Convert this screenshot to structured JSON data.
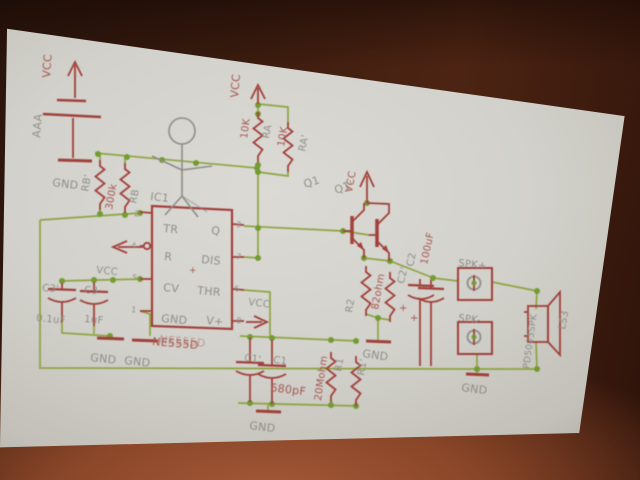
{
  "scene": {
    "type": "projected-circuit-schematic-photo",
    "colors": {
      "wire_green": "#8ba23a",
      "junction_green": "#6f9a2c",
      "symbol_red": "#a03a35",
      "text_gray": "#8d8a84",
      "text_red": "#a5514b",
      "screen_white": "#d6d5d0",
      "room_brown": "#3c1c0f"
    }
  },
  "schematic": {
    "ic": {
      "name": "IC1",
      "value": "NE555D",
      "pins_left": [
        "TR",
        "R",
        "CV",
        "GND"
      ],
      "pins_right": [
        "Q",
        "DIS",
        "THR",
        "V+"
      ],
      "pin_numbers_left": [
        "2",
        "4",
        "5",
        "1"
      ],
      "pin_numbers_right": [
        "3",
        "7",
        "6",
        "8"
      ]
    },
    "components": [
      {
        "name": "BAT",
        "value": "AAA"
      },
      {
        "name": "RB/RB'",
        "value": "300k"
      },
      {
        "name": "RA/RA'",
        "value": "10K"
      },
      {
        "name": "R1/R1'",
        "value": "20Mohm"
      },
      {
        "name": "R2/R2'",
        "value": "82ohm"
      },
      {
        "name": "C1/C1'",
        "value": "680pF"
      },
      {
        "name": "C2/C2'",
        "value": "100uF"
      },
      {
        "name": "C3/C3'",
        "value": "0.1uF / 1uF"
      },
      {
        "name": "Q1/Q1'",
        "value": ""
      },
      {
        "name": "LS3",
        "value": "PD5003SPK"
      },
      {
        "name": "SPK+",
        "value": ""
      },
      {
        "name": "SPK-",
        "value": ""
      }
    ],
    "labels": [
      {
        "id": "vcc-battery-label",
        "text": "VCC",
        "x": 50,
        "y": 78,
        "rot": -86,
        "c": "r",
        "s": 11
      },
      {
        "id": "battery-name",
        "text": "AAA",
        "x": 40,
        "y": 138,
        "rot": -85,
        "c": "g",
        "s": 11
      },
      {
        "id": "gnd-battery-label",
        "text": "GND",
        "x": 52,
        "y": 186,
        "rot": 7,
        "c": "g",
        "s": 11
      },
      {
        "id": "rb2-name",
        "text": "RB'",
        "x": 88,
        "y": 192,
        "rot": -80,
        "c": "g",
        "s": 10
      },
      {
        "id": "rb-value",
        "text": "300k",
        "x": 112,
        "y": 210,
        "rot": -80,
        "c": "r",
        "s": 10
      },
      {
        "id": "rb-name",
        "text": "RB",
        "x": 136,
        "y": 204,
        "rot": -78,
        "c": "g",
        "s": 10
      },
      {
        "id": "ic1-name",
        "text": "IC1",
        "x": 150,
        "y": 200,
        "rot": 6,
        "c": "g",
        "s": 11
      },
      {
        "id": "pin-tr",
        "text": "TR",
        "x": 163,
        "y": 232,
        "rot": 5,
        "c": "g",
        "s": 11
      },
      {
        "id": "pin-q",
        "text": "Q",
        "x": 211,
        "y": 234,
        "rot": 5,
        "c": "g",
        "s": 11
      },
      {
        "id": "pin-r",
        "text": "R",
        "x": 164,
        "y": 260,
        "rot": 5,
        "c": "g",
        "s": 11
      },
      {
        "id": "pin-dis",
        "text": "DIS",
        "x": 201,
        "y": 263,
        "rot": 5,
        "c": "g",
        "s": 11
      },
      {
        "id": "pin-cv",
        "text": "CV",
        "x": 163,
        "y": 291,
        "rot": 5,
        "c": "g",
        "s": 11
      },
      {
        "id": "pin-thr",
        "text": "THR",
        "x": 197,
        "y": 294,
        "rot": 5,
        "c": "g",
        "s": 11
      },
      {
        "id": "pin-gnd",
        "text": "GND",
        "x": 161,
        "y": 322,
        "rot": 5,
        "c": "g",
        "s": 11
      },
      {
        "id": "pin-vplus",
        "text": "V+",
        "x": 206,
        "y": 324,
        "rot": 5,
        "c": "g",
        "s": 11
      },
      {
        "id": "pin-num-2",
        "text": "2",
        "x": 134,
        "y": 216,
        "rot": 5,
        "c": "g",
        "s": 8
      },
      {
        "id": "pin-num-4",
        "text": "4",
        "x": 131,
        "y": 248,
        "rot": 5,
        "c": "g",
        "s": 8
      },
      {
        "id": "pin-num-5",
        "text": "5",
        "x": 132,
        "y": 280,
        "rot": 5,
        "c": "g",
        "s": 8
      },
      {
        "id": "pin-num-1",
        "text": "1",
        "x": 131,
        "y": 312,
        "rot": 5,
        "c": "g",
        "s": 8
      },
      {
        "id": "pin-num-3",
        "text": "3",
        "x": 236,
        "y": 227,
        "rot": 5,
        "c": "g",
        "s": 8
      },
      {
        "id": "pin-num-7",
        "text": "7",
        "x": 236,
        "y": 259,
        "rot": 5,
        "c": "g",
        "s": 8
      },
      {
        "id": "pin-num-6",
        "text": "6",
        "x": 234,
        "y": 291,
        "rot": 5,
        "c": "g",
        "s": 8
      },
      {
        "id": "pin-num-8",
        "text": "8",
        "x": 236,
        "y": 323,
        "rot": 5,
        "c": "g",
        "s": 8
      },
      {
        "id": "ic-origin-cross",
        "text": "+",
        "x": 189,
        "y": 273,
        "rot": 0,
        "c": "r",
        "s": 9
      },
      {
        "id": "ic1-value-ghost",
        "text": "NE555D",
        "x": 159,
        "y": 343,
        "rot": 5,
        "c": "r",
        "s": 11,
        "ghost": true
      },
      {
        "id": "ic1-value",
        "text": "NE555D",
        "x": 152,
        "y": 345,
        "rot": 5,
        "c": "r",
        "s": 11
      },
      {
        "id": "vcc-reset-label",
        "text": "VCC",
        "x": 96,
        "y": 273,
        "rot": 6,
        "c": "g",
        "s": 10
      },
      {
        "id": "c3b-name",
        "text": "C3'",
        "x": 42,
        "y": 291,
        "rot": 4,
        "c": "g",
        "s": 10
      },
      {
        "id": "c3-name",
        "text": "C3",
        "x": 84,
        "y": 293,
        "rot": 4,
        "c": "g",
        "s": 10
      },
      {
        "id": "c3b-value",
        "text": "0.1uF",
        "x": 36,
        "y": 321,
        "rot": 5,
        "c": "g",
        "s": 10
      },
      {
        "id": "c3-value",
        "text": "1uF",
        "x": 84,
        "y": 322,
        "rot": 5,
        "c": "g",
        "s": 10
      },
      {
        "id": "gnd-c3-label",
        "text": "GND",
        "x": 90,
        "y": 361,
        "rot": 6,
        "c": "g",
        "s": 11
      },
      {
        "id": "gnd-pin1-label",
        "text": "GND",
        "x": 124,
        "y": 364,
        "rot": 6,
        "c": "g",
        "s": 11
      },
      {
        "id": "vcc-ra-label",
        "text": "VCC",
        "x": 238,
        "y": 98,
        "rot": -85,
        "c": "r",
        "s": 11
      },
      {
        "id": "ra-value",
        "text": "10K",
        "x": 247,
        "y": 139,
        "rot": -82,
        "c": "r",
        "s": 10
      },
      {
        "id": "ra-name",
        "text": "RA",
        "x": 269,
        "y": 139,
        "rot": -80,
        "c": "g",
        "s": 10
      },
      {
        "id": "ra2-value",
        "text": "10K",
        "x": 284,
        "y": 147,
        "rot": -80,
        "c": "r",
        "s": 10
      },
      {
        "id": "ra2-name",
        "text": "RA'",
        "x": 305,
        "y": 152,
        "rot": -78,
        "c": "g",
        "s": 10
      },
      {
        "id": "q1-name",
        "text": "Q1",
        "x": 305,
        "y": 188,
        "rot": -18,
        "c": "g",
        "s": 11
      },
      {
        "id": "q1b-name",
        "text": "Q1'",
        "x": 336,
        "y": 194,
        "rot": -20,
        "c": "g",
        "s": 11
      },
      {
        "id": "vcc-q-label",
        "text": "VCC",
        "x": 352,
        "y": 193,
        "rot": -80,
        "c": "r",
        "s": 10
      },
      {
        "id": "vcc-vplus-label",
        "text": "VCC",
        "x": 248,
        "y": 305,
        "rot": 7,
        "c": "g",
        "s": 10
      },
      {
        "id": "c2b-name",
        "text": "C2'",
        "x": 404,
        "y": 284,
        "rot": -78,
        "c": "g",
        "s": 10
      },
      {
        "id": "c2-name",
        "text": "C2",
        "x": 413,
        "y": 267,
        "rot": -78,
        "c": "g",
        "s": 10
      },
      {
        "id": "c2-value",
        "text": "100uF",
        "x": 427,
        "y": 265,
        "rot": -78,
        "c": "r",
        "s": 10
      },
      {
        "id": "c2-plus-mark",
        "text": "+",
        "x": 399,
        "y": 311,
        "rot": 0,
        "c": "r",
        "s": 10
      },
      {
        "id": "c2b-plus-mark",
        "text": "+",
        "x": 410,
        "y": 321,
        "rot": 0,
        "c": "r",
        "s": 10
      },
      {
        "id": "r2-name",
        "text": "R2",
        "x": 352,
        "y": 313,
        "rot": -80,
        "c": "g",
        "s": 10
      },
      {
        "id": "r2-value",
        "text": "82ohm",
        "x": 378,
        "y": 310,
        "rot": -80,
        "c": "r",
        "s": 10
      },
      {
        "id": "gnd-r2-label",
        "text": "GND",
        "x": 362,
        "y": 357,
        "rot": 8,
        "c": "g",
        "s": 11
      },
      {
        "id": "c1b-name",
        "text": "C1'",
        "x": 244,
        "y": 361,
        "rot": 6,
        "c": "g",
        "s": 10
      },
      {
        "id": "c1-name",
        "text": "C1",
        "x": 273,
        "y": 363,
        "rot": 6,
        "c": "g",
        "s": 10
      },
      {
        "id": "c1-value",
        "text": "680pF",
        "x": 270,
        "y": 391,
        "rot": 7,
        "c": "r",
        "s": 11
      },
      {
        "id": "gnd-c1-label",
        "text": "GND",
        "x": 249,
        "y": 429,
        "rot": 7,
        "c": "g",
        "s": 11
      },
      {
        "id": "r1-value",
        "text": "20Mohm",
        "x": 321,
        "y": 401,
        "rot": -82,
        "c": "r",
        "s": 10
      },
      {
        "id": "r1-name",
        "text": "R1",
        "x": 341,
        "y": 372,
        "rot": -80,
        "c": "g",
        "s": 10
      },
      {
        "id": "r1b-name",
        "text": "R1'",
        "x": 364,
        "y": 376,
        "rot": -80,
        "c": "g",
        "s": 10
      },
      {
        "id": "spk-plus-label",
        "text": "SPK+",
        "x": 458,
        "y": 266,
        "rot": 6,
        "c": "g",
        "s": 10
      },
      {
        "id": "spk-minus-label",
        "text": "SPK-",
        "x": 458,
        "y": 321,
        "rot": 6,
        "c": "g",
        "s": 10
      },
      {
        "id": "gnd-spk-label",
        "text": "GND",
        "x": 461,
        "y": 391,
        "rot": 7,
        "c": "g",
        "s": 11
      },
      {
        "id": "speaker-part-number",
        "text": "PD5003SPK",
        "x": 529,
        "y": 369,
        "rot": -82,
        "c": "g",
        "s": 9
      },
      {
        "id": "speaker-name",
        "text": "LS3",
        "x": 565,
        "y": 330,
        "rot": -80,
        "c": "g",
        "s": 10
      }
    ]
  }
}
